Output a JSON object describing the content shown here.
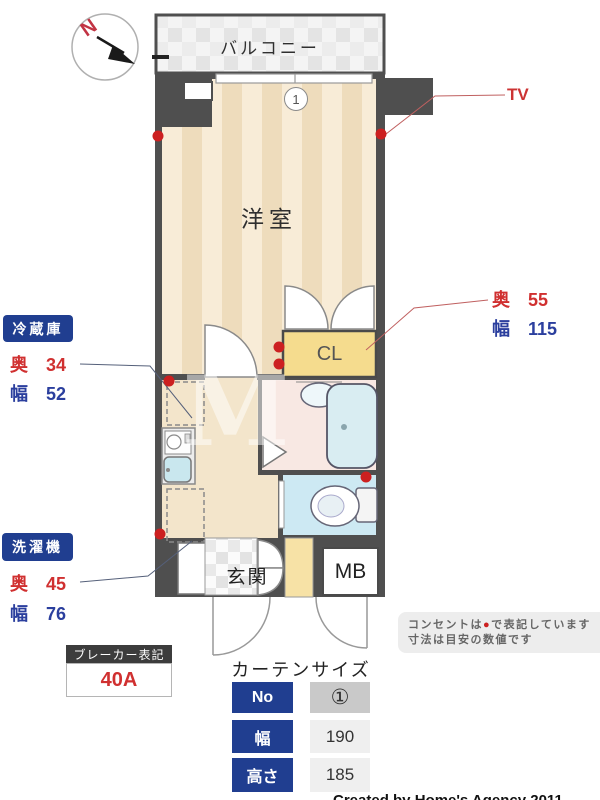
{
  "compass": {
    "letter": "N"
  },
  "plan": {
    "balcony_label": "バルコニー",
    "room_label": "洋室",
    "closet_label": "CL",
    "entrance_label": "玄関",
    "meter_box_label": "MB",
    "tv_label": "TV",
    "window_marker": "1"
  },
  "annotations": {
    "closet_size": {
      "depth_label": "奥",
      "depth_value": "55",
      "width_label": "幅",
      "width_value": "115"
    },
    "fridge": {
      "title": "冷蔵庫",
      "depth_label": "奥",
      "depth_value": "34",
      "width_label": "幅",
      "width_value": "52"
    },
    "washer": {
      "title": "洗濯機",
      "depth_label": "奥",
      "depth_value": "45",
      "width_label": "幅",
      "width_value": "76"
    },
    "breaker": {
      "title": "ブレーカー表記",
      "value": "40A"
    }
  },
  "note": {
    "line1_before": "コンセントは",
    "symbol": "●",
    "line1_after": "で表記しています",
    "line2": "寸法は目安の数値です"
  },
  "curtain": {
    "title": "カーテンサイズ",
    "rows": [
      {
        "label": "No",
        "value": "①"
      },
      {
        "label": "幅",
        "value": "190"
      },
      {
        "label": "高さ",
        "value": "185"
      }
    ]
  },
  "watermark": "M",
  "footer": {
    "cropped_text": "Created by Home's Agency 2011"
  },
  "colors": {
    "wall": "#4f4f4f",
    "floor_stripe_light": "#f8ecd7",
    "floor_stripe_dark": "#eedcbc",
    "corridor_beige": "#f3e5cb",
    "closet_yellow": "#f5dc8e",
    "bath_pink": "#f8e8e3",
    "toilet_blue": "#cde9f3",
    "tub_blue": "#d9edf2",
    "accent_red": "#d03030",
    "accent_blue": "#203e90",
    "outlet_red": "#cc2020"
  }
}
